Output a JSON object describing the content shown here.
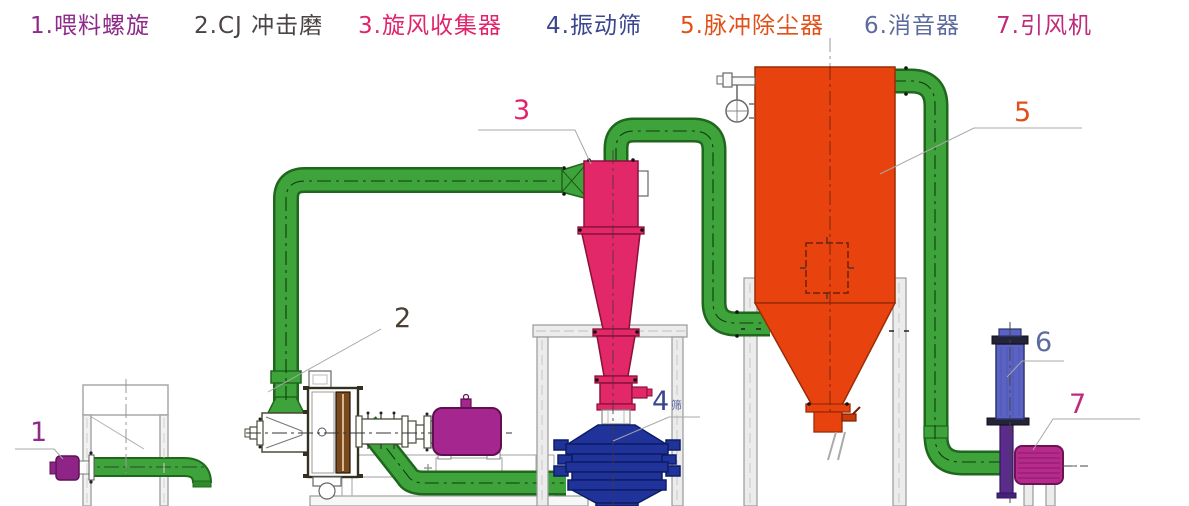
{
  "legend": {
    "items": [
      {
        "label": "1.喂料螺旋",
        "color": "#8e2a8a"
      },
      {
        "label": "2.CJ 冲击磨",
        "color": "#4a4444"
      },
      {
        "label": "3.旋风收集器",
        "color": "#e0246a"
      },
      {
        "label": "4.振动筛",
        "color": "#3a4690"
      },
      {
        "label": "5.脉冲除尘器",
        "color": "#e05018"
      },
      {
        "label": "6.消音器",
        "color": "#5c6b9e"
      },
      {
        "label": "7.引风机",
        "color": "#c02a7a"
      }
    ]
  },
  "diagram": {
    "callouts": [
      {
        "number": "1",
        "color": "#8e2a8a"
      },
      {
        "number": "2",
        "color": "#4a3f30"
      },
      {
        "number": "3",
        "color": "#e0246a"
      },
      {
        "number": "4",
        "color": "#3a4690",
        "annotation": "筛"
      },
      {
        "number": "5",
        "color": "#e05018"
      },
      {
        "number": "6",
        "color": "#5c6b9e"
      },
      {
        "number": "7",
        "color": "#c02a7a"
      }
    ],
    "colors": {
      "pipe_green": "#3fa33b",
      "pipe_outline": "#1e671c",
      "cyclone_pink": "#e22868",
      "dust_collector_orange": "#e8430e",
      "screen_blue": "#20339a",
      "muffler_blue": "#5a63c4",
      "fan_magenta": "#b62a8c",
      "mill_motor_magenta": "#a5268e",
      "feeder_motor_purple": "#8e2486",
      "silencer_pipe_purple": "#5a2d8c",
      "frame_gray": "#ececec"
    }
  }
}
